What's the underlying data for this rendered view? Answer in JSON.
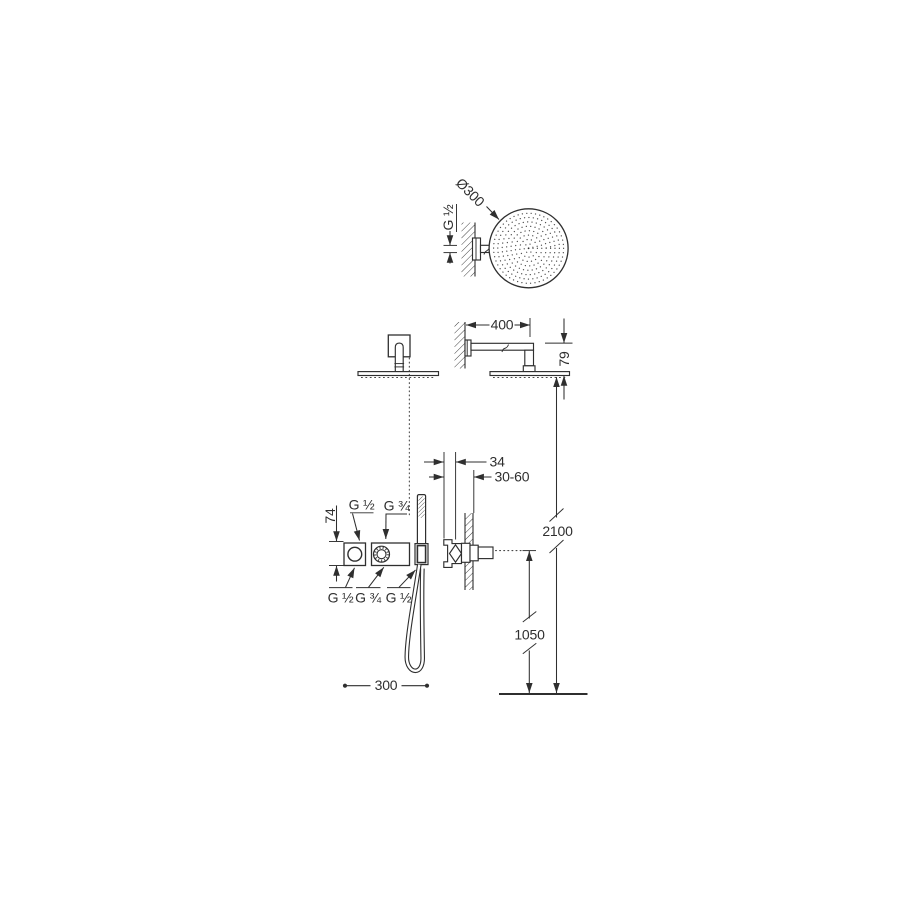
{
  "drawing": {
    "background": "#ffffff",
    "line_color": "#2f2f2f",
    "labels": {
      "head_diameter": "Ø300",
      "head_connection": "G ½",
      "arm_length": "400",
      "head_offset": "79",
      "valve_body_depth": "34",
      "install_depth_range": "30-60",
      "height_total": "2100",
      "height_valve": "1050",
      "trim_height": "74",
      "inlet_top_left": "G ½",
      "inlet_top_right": "G ¾",
      "outlet_bottom_left": "G ½",
      "outlet_bottom_center": "G ¾",
      "outlet_bottom_right": "G ½",
      "handshower_offset": "300"
    }
  }
}
